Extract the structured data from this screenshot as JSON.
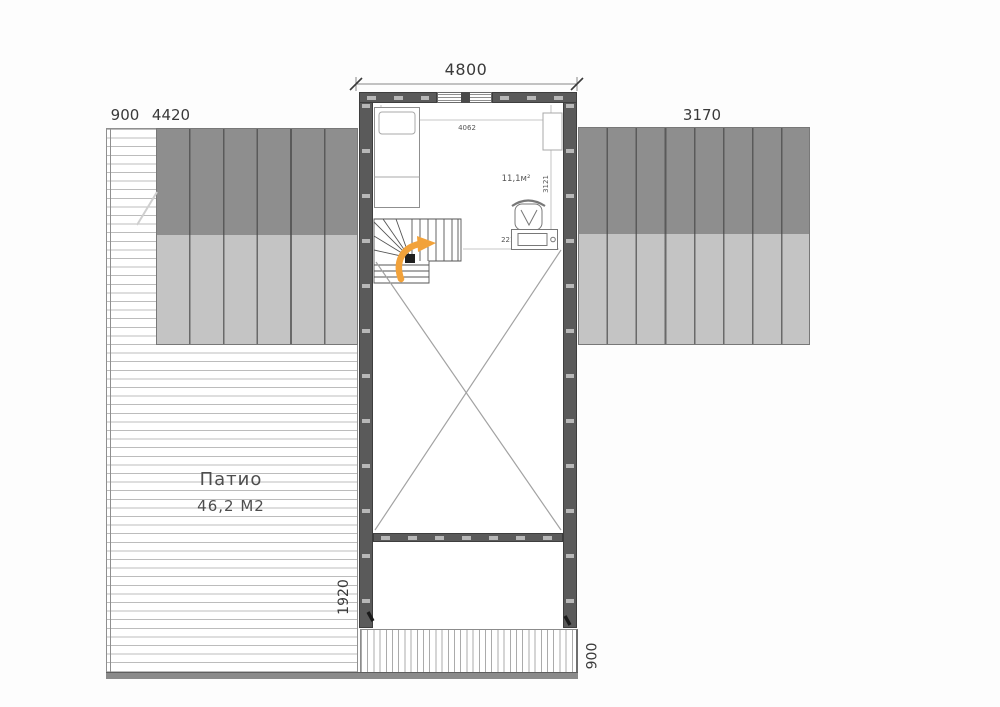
{
  "colors": {
    "wall": "#5a5a5a",
    "roof_dark": "#8e8e8e",
    "roof_light": "#c4c4c4",
    "deck_line": "#bcbcbc",
    "drawing_line": "#9a9a9a",
    "arrow_orange": "#f2a23a"
  },
  "dimensions": {
    "overall_width": "4800",
    "left_edge_strip": "900",
    "left_roof_width": "4420",
    "right_roof_width": "3170",
    "left_lower_height": "1920",
    "bottom_balcony_depth": "900",
    "room_inner_width": "4062",
    "bed_length": "2321",
    "room_inner_depth": "3121",
    "workspace_width": "2212"
  },
  "rooms": {
    "upper_room_area": "11,1м²",
    "patio": {
      "name": "Патио",
      "area": "46,2 М2"
    }
  }
}
